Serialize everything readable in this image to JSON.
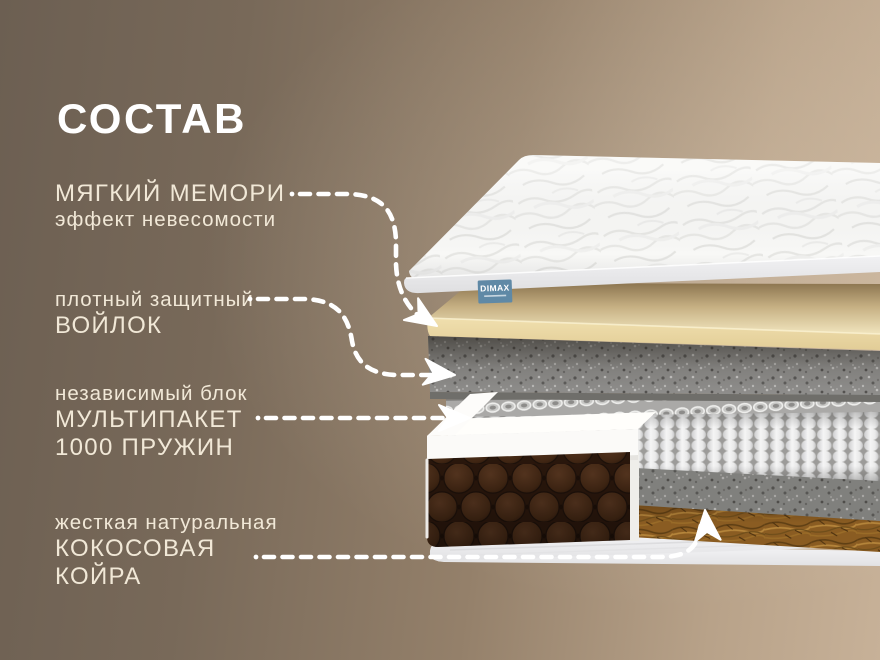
{
  "page": {
    "title": "СОСТАВ"
  },
  "brand": {
    "name": "DIMAX",
    "tag_color": "#5f89a6"
  },
  "labels": [
    {
      "id": "memory-foam",
      "lines": [
        {
          "t": "МЯГКИЙ МЕМОРИ",
          "s": "big"
        },
        {
          "t": "эффект невесомости",
          "s": "small"
        }
      ]
    },
    {
      "id": "protective-felt",
      "lines": [
        {
          "t": "плотный защитный",
          "s": "small"
        },
        {
          "t": "ВОЙЛОК",
          "s": "big"
        }
      ]
    },
    {
      "id": "spring-block",
      "lines": [
        {
          "t": "независимый блок",
          "s": "small"
        },
        {
          "t": "МУЛЬТИПАКЕТ",
          "s": "big"
        },
        {
          "t": "1000 ПРУЖИН",
          "s": "big"
        }
      ]
    },
    {
      "id": "coconut-coir",
      "lines": [
        {
          "t": "жесткая натуральная",
          "s": "small"
        },
        {
          "t": "КОКОСОВАЯ",
          "s": "big"
        },
        {
          "t": "КОЙРА",
          "s": "big"
        }
      ]
    }
  ],
  "colors": {
    "background_left": "#6c5f52",
    "background_right": "#c7b198",
    "title_text": "#ffffff",
    "label_text": "#f1e8d7",
    "arrow": "#ffffff",
    "top_cover": "#f8f8f6",
    "memory_foam": "#eedfb2",
    "felt": "#8f8e8c",
    "springs": "#efefef",
    "coconut_coir": "#8a5c22",
    "side_quilt": "#3a2112",
    "bottom_base": "#f1f1f3"
  }
}
